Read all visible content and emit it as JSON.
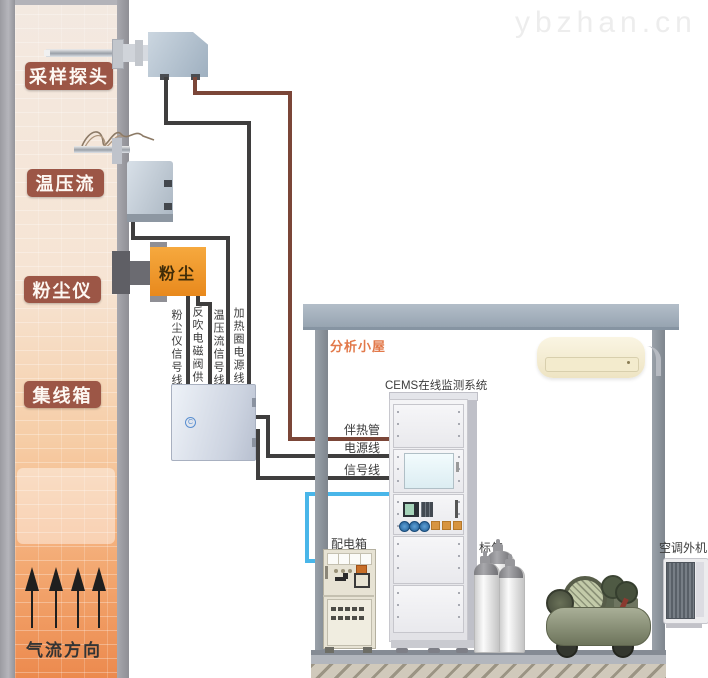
{
  "watermark": {
    "text": "ybzhan.cn"
  },
  "stack": {
    "labels": [
      {
        "text": "采样探头"
      },
      {
        "text": "温压流"
      },
      {
        "text": "粉尘仪"
      },
      {
        "text": "集线箱"
      }
    ],
    "airflow_label": "气流方向"
  },
  "devices": {
    "dust_meter_text": "粉尘"
  },
  "cables": {
    "dust_signal": "粉尘仪信号线",
    "blowback_power": "反吹电磁阀供电线",
    "tpf_signal": "温压流信号线",
    "heater_power": "加热圈电源线",
    "heat_trace": "伴热管",
    "power": "电源线",
    "signal": "信号线"
  },
  "shed": {
    "title": "分析小屋",
    "cems_title": "CEMS在线监测系统",
    "power_box_label": "配电箱",
    "std_gas_label": "标气",
    "ac_outdoor_label": "空调外机"
  },
  "colors": {
    "stack_label_bg": "#9c5646",
    "heat_trace_wire": "#7b4638",
    "signal_wire": "#3f3e3e",
    "blue_wire": "#49b6e9",
    "dust_meter_orange": "#f09a2e",
    "shed_title_color": "#e2794a"
  }
}
